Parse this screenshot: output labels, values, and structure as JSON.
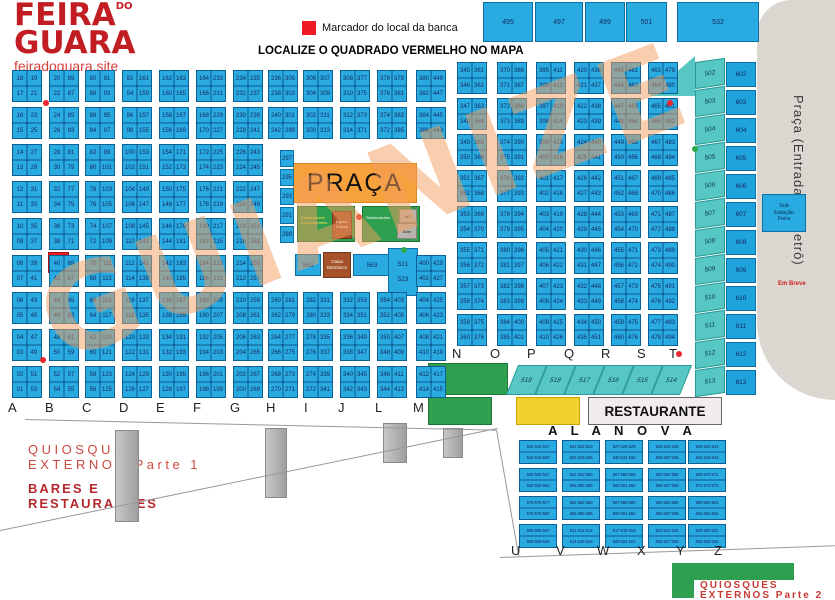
{
  "logo": {
    "line1": "FEIRA",
    "do": "DO",
    "line2": "GUARA",
    "site": "feiradoguara.site"
  },
  "legend": {
    "marker_label": "Marcador do local da banca",
    "title": "LOCALIZE O QUADRADO VERMELHO NO MAPA"
  },
  "colors": {
    "cell_blue": "#29abe2",
    "teal": "#56c7c3",
    "green": "#2e9e4f",
    "yellow": "#f2d12e",
    "orange": "#f6a13c",
    "marker_red": "#ed1c24",
    "brown": "#a5522a",
    "metro_gray": "#dcd6d0"
  },
  "watermark": {
    "text": "GUIANIZE"
  },
  "praca": {
    "label": "PRAÇA"
  },
  "green_left": {
    "line1": "Restaurantes",
    "line2": "e Lanchonetes",
    "stage1": "Espaço",
    "stage2": "Cultural"
  },
  "green_right": {
    "label": "Restaurantes",
    "wc": "WC",
    "adm": "Adm"
  },
  "mid_boxes": {
    "b583": "583",
    "caixa1": "Caixa",
    "caixa2": "Eletrônico",
    "b563": "563",
    "b521": "521",
    "b523": "523"
  },
  "metro": {
    "label": "Praça (Entrada do Metrô)",
    "em_breve": "Em Breve",
    "sub1": "Sub",
    "sub2": "Estação",
    "sub3": "Feira"
  },
  "restaurante_label": "RESTAURANTE",
  "ala_nova_title": "A L A   N O V A",
  "bottom_labels": {
    "quiosques1a": "QUIOSQUES",
    "quiosques1b": "EXTERNOS Parte 1",
    "bares1": "BARES E",
    "bares2": "RESTAURANTES",
    "quiosques2a": "QUIOSQUES",
    "quiosques2b": "EXTERNOS Parte 2"
  },
  "top_boxes": [
    [
      483,
      50,
      "495"
    ],
    [
      535,
      48,
      "497"
    ],
    [
      585,
      40,
      "499"
    ],
    [
      626,
      41,
      "501"
    ],
    [
      677,
      82,
      "532"
    ]
  ],
  "right_strip": {
    "teal": [
      "502",
      "503",
      "504",
      "505",
      "506",
      "507",
      "508",
      "509",
      "510",
      "511",
      "512",
      "513"
    ],
    "squares": [
      "602",
      "603",
      "604",
      "605",
      "606",
      "607",
      "608",
      "609",
      "610",
      "611",
      "612",
      "613"
    ]
  },
  "teal_bottom": [
    "519",
    "518",
    "517",
    "516",
    "515",
    "514"
  ],
  "letters": {
    "bottom": [
      [
        "A",
        8
      ],
      [
        "B",
        45
      ],
      [
        "C",
        82
      ],
      [
        "D",
        119
      ],
      [
        "E",
        156
      ],
      [
        "F",
        193
      ],
      [
        "G",
        230
      ],
      [
        "H",
        266
      ],
      [
        "I",
        304
      ],
      [
        "J",
        338
      ],
      [
        "L",
        375
      ],
      [
        "M",
        413
      ]
    ],
    "mid": [
      [
        "N",
        452
      ],
      [
        "O",
        490
      ],
      [
        "P",
        527
      ],
      [
        "Q",
        564
      ],
      [
        "R",
        601
      ],
      [
        "S",
        637
      ],
      [
        "T",
        669
      ]
    ],
    "ala": [
      [
        "U",
        511
      ],
      [
        "V",
        556
      ],
      [
        "W",
        597
      ],
      [
        "X",
        637
      ],
      [
        "Y",
        676
      ],
      [
        "Z",
        714
      ]
    ]
  },
  "left_grid": {
    "blocks": [
      [
        12,
        70,
        "18,19,17,21"
      ],
      [
        12,
        107,
        "16,23,15,25"
      ],
      [
        12,
        144,
        "14,27,13,29"
      ],
      [
        12,
        181,
        "12,31,11,33"
      ],
      [
        12,
        218,
        "10,35,09,37"
      ],
      [
        12,
        255,
        "08,39,07,41"
      ],
      [
        12,
        292,
        "06,43,05,45"
      ],
      [
        12,
        329,
        "04,47,03,49"
      ],
      [
        12,
        366,
        "02,51,01,53"
      ],
      [
        49,
        70,
        "20,89,22,87"
      ],
      [
        49,
        107,
        "24,85,26,83"
      ],
      [
        49,
        144,
        "28,81,30,79"
      ],
      [
        49,
        181,
        "32,77,34,75"
      ],
      [
        49,
        218,
        "36,73,38,71"
      ],
      [
        49,
        255,
        "40,69,42,67"
      ],
      [
        49,
        292,
        "44,65,46,63"
      ],
      [
        49,
        329,
        "48,61,50,59"
      ],
      [
        49,
        366,
        "52,57,54,55"
      ],
      [
        85,
        70,
        "90,91,88,93"
      ],
      [
        85,
        107,
        "86,95,84,97"
      ],
      [
        85,
        144,
        "82,99,80,101"
      ],
      [
        85,
        181,
        "78,103,76,105"
      ],
      [
        85,
        218,
        "74,107,72,109"
      ],
      [
        85,
        255,
        "70,111,68,113"
      ],
      [
        85,
        292,
        "66,115,64,117"
      ],
      [
        85,
        329,
        "62,119,60,121"
      ],
      [
        85,
        366,
        "58,123,56,125"
      ],
      [
        122,
        70,
        "92,161,94,159"
      ],
      [
        122,
        107,
        "96,157,98,155"
      ],
      [
        122,
        144,
        "100,153,102,151"
      ],
      [
        122,
        181,
        "104,149,106,147"
      ],
      [
        122,
        218,
        "108,145,110,143"
      ],
      [
        122,
        255,
        "112,141,114,139"
      ],
      [
        122,
        292,
        "116,137,118,135"
      ],
      [
        122,
        329,
        "120,133,122,131"
      ],
      [
        122,
        366,
        "124,129,126,127"
      ],
      [
        159,
        70,
        "162,163,160,165"
      ],
      [
        159,
        107,
        "158,167,156,169"
      ],
      [
        159,
        144,
        "154,171,152,173"
      ],
      [
        159,
        181,
        "150,175,148,177"
      ],
      [
        159,
        218,
        "146,179,144,181"
      ],
      [
        159,
        255,
        "142,183,140,185"
      ],
      [
        159,
        292,
        "138,187,136,189"
      ],
      [
        159,
        329,
        "134,191,132,193"
      ],
      [
        159,
        366,
        "130,195,128,197"
      ],
      [
        196,
        70,
        "164,233,166,231"
      ],
      [
        196,
        107,
        "168,229,170,227"
      ],
      [
        196,
        144,
        "172,225,174,223"
      ],
      [
        196,
        181,
        "176,221,178,219"
      ],
      [
        196,
        218,
        "180,217,182,215"
      ],
      [
        196,
        255,
        "184,213,186,211"
      ],
      [
        196,
        292,
        "188,209,190,207"
      ],
      [
        196,
        329,
        "192,205,194,203"
      ],
      [
        196,
        366,
        "196,201,198,199"
      ],
      [
        233,
        70,
        "234,235,232,237"
      ],
      [
        233,
        107,
        "230,239,228,241"
      ],
      [
        233,
        144,
        "226,243,224,245"
      ],
      [
        233,
        181,
        "222,247,220,249"
      ],
      [
        233,
        218,
        "218,251,216,253"
      ],
      [
        233,
        255,
        "214,255,212,257"
      ],
      [
        233,
        292,
        "210,259,208,261"
      ],
      [
        233,
        329,
        "206,263,204,265"
      ],
      [
        233,
        366,
        "202,267,200,269"
      ],
      [
        268,
        70,
        "236,305,238,303"
      ],
      [
        268,
        107,
        "240,301,242,299"
      ],
      [
        268,
        292,
        "260,281,262,279"
      ],
      [
        268,
        329,
        "264,277,266,275"
      ],
      [
        268,
        366,
        "268,273,270,271"
      ],
      [
        303,
        70,
        "306,307,304,309"
      ],
      [
        303,
        107,
        "302,311,300,313"
      ],
      [
        303,
        292,
        "282,331,280,333"
      ],
      [
        303,
        329,
        "278,335,276,337"
      ],
      [
        303,
        366,
        "274,339,272,341"
      ],
      [
        340,
        70,
        "308,377,310,375"
      ],
      [
        340,
        107,
        "312,373,314,371"
      ],
      [
        340,
        292,
        "332,353,334,351"
      ],
      [
        340,
        329,
        "336,349,338,347"
      ],
      [
        340,
        366,
        "340,345,342,343"
      ],
      [
        377,
        70,
        "378,379,376,381"
      ],
      [
        377,
        107,
        "374,383,372,385"
      ],
      [
        377,
        292,
        "354,403,352,405"
      ],
      [
        377,
        329,
        "350,407,348,409"
      ],
      [
        377,
        366,
        "346,411,344,413"
      ],
      [
        416,
        70,
        "380,449,382,447"
      ],
      [
        416,
        107,
        "384,445,386,443"
      ],
      [
        416,
        255,
        "400,429,402,427"
      ],
      [
        416,
        292,
        "404,425,406,423"
      ],
      [
        416,
        329,
        "408,421,410,419"
      ],
      [
        416,
        366,
        "412,417,414,415"
      ]
    ],
    "singles": [
      [
        280,
        150,
        "297"
      ],
      [
        280,
        169,
        "295"
      ],
      [
        280,
        188,
        "293"
      ],
      [
        280,
        207,
        "291"
      ],
      [
        280,
        226,
        "289"
      ]
    ]
  },
  "right_grid": {
    "blocks": [
      [
        457,
        62,
        "345,361,346,362"
      ],
      [
        457,
        98,
        "347,363,348,364"
      ],
      [
        457,
        134,
        "349,365,350,366"
      ],
      [
        457,
        170,
        "351,367,352,368"
      ],
      [
        457,
        206,
        "353,369,354,370"
      ],
      [
        457,
        242,
        "355,371,356,372"
      ],
      [
        457,
        278,
        "357,373,358,374"
      ],
      [
        457,
        314,
        "359,375,360,376"
      ],
      [
        497,
        62,
        "370,386,371,387"
      ],
      [
        497,
        98,
        "372,388,373,389"
      ],
      [
        497,
        134,
        "374,390,375,391"
      ],
      [
        497,
        170,
        "376,392,377,393"
      ],
      [
        497,
        206,
        "378,394,379,395"
      ],
      [
        497,
        242,
        "380,396,381,397"
      ],
      [
        497,
        278,
        "382,398,383,399"
      ],
      [
        497,
        314,
        "384,400,385,401"
      ],
      [
        536,
        62,
        "395,411,396,412"
      ],
      [
        536,
        98,
        "397,413,398,414"
      ],
      [
        536,
        134,
        "399,415,400,416"
      ],
      [
        536,
        170,
        "401,417,402,418"
      ],
      [
        536,
        206,
        "403,419,404,420"
      ],
      [
        536,
        242,
        "405,421,406,422"
      ],
      [
        536,
        278,
        "407,423,408,424"
      ],
      [
        536,
        314,
        "409,425,410,426"
      ],
      [
        574,
        62,
        "420,436,421,437"
      ],
      [
        574,
        98,
        "422,438,423,439"
      ],
      [
        574,
        134,
        "424,440,425,441"
      ],
      [
        574,
        170,
        "426,442,427,443"
      ],
      [
        574,
        206,
        "428,444,429,445"
      ],
      [
        574,
        242,
        "430,446,431,447"
      ],
      [
        574,
        278,
        "432,448,433,449"
      ],
      [
        574,
        314,
        "434,450,435,451"
      ],
      [
        611,
        62,
        "445,461,446,462"
      ],
      [
        611,
        98,
        "447,463,448,464"
      ],
      [
        611,
        134,
        "449,465,450,466"
      ],
      [
        611,
        170,
        "451,467,452,468"
      ],
      [
        611,
        206,
        "453,469,454,470"
      ],
      [
        611,
        242,
        "455,471,456,472"
      ],
      [
        611,
        278,
        "457,473,458,474"
      ],
      [
        611,
        314,
        "459,475,460,476"
      ],
      [
        648,
        62,
        "463,479,464,480"
      ],
      [
        648,
        98,
        "465,481,466,482"
      ],
      [
        648,
        134,
        "467,483,468,484"
      ],
      [
        648,
        170,
        "469,485,470,486"
      ],
      [
        648,
        206,
        "471,487,472,488"
      ],
      [
        648,
        242,
        "473,489,474,490"
      ],
      [
        648,
        278,
        "475,491,476,492"
      ],
      [
        648,
        314,
        "477,493,478,494"
      ]
    ]
  },
  "ala_nova": {
    "blocks": [
      [
        519,
        440,
        "515 516 517",
        "518 519 520"
      ],
      [
        562,
        440,
        "521 522 523",
        "524 525 526"
      ],
      [
        605,
        440,
        "527 528 529",
        "530 531 532"
      ],
      [
        648,
        440,
        "533 534 535",
        "536 537 538"
      ],
      [
        688,
        440,
        "539 540 541",
        "542 543 544"
      ],
      [
        519,
        468,
        "545 546 547",
        "548 549 550"
      ],
      [
        562,
        468,
        "551 552 553",
        "554 555 556"
      ],
      [
        605,
        468,
        "557 558 559",
        "560 561 562"
      ],
      [
        648,
        468,
        "563 564 565",
        "566 567 568"
      ],
      [
        688,
        468,
        "569 570 571",
        "572 573 574"
      ],
      [
        519,
        496,
        "575 576 577",
        "578 579 580"
      ],
      [
        562,
        496,
        "581 582 583",
        "584 585 586"
      ],
      [
        605,
        496,
        "587 588 589",
        "590 591 592"
      ],
      [
        648,
        496,
        "593 594 595",
        "596 597 598"
      ],
      [
        688,
        496,
        "599 600 601",
        "602 603 604"
      ],
      [
        519,
        524,
        "605 606 607",
        "608 609 610"
      ],
      [
        562,
        524,
        "611 612 613",
        "614 615 616"
      ],
      [
        605,
        524,
        "617 618 619",
        "620 621 622"
      ],
      [
        648,
        524,
        "623 624 625",
        "626 627 628"
      ],
      [
        688,
        524,
        "629 630 631",
        "632 633 634"
      ]
    ]
  },
  "dots": {
    "red": [
      [
        43,
        100
      ],
      [
        40,
        357
      ],
      [
        676,
        351
      ],
      [
        667,
        100
      ],
      [
        356,
        214
      ]
    ],
    "green": [
      [
        401,
        247
      ],
      [
        692,
        146
      ]
    ]
  }
}
